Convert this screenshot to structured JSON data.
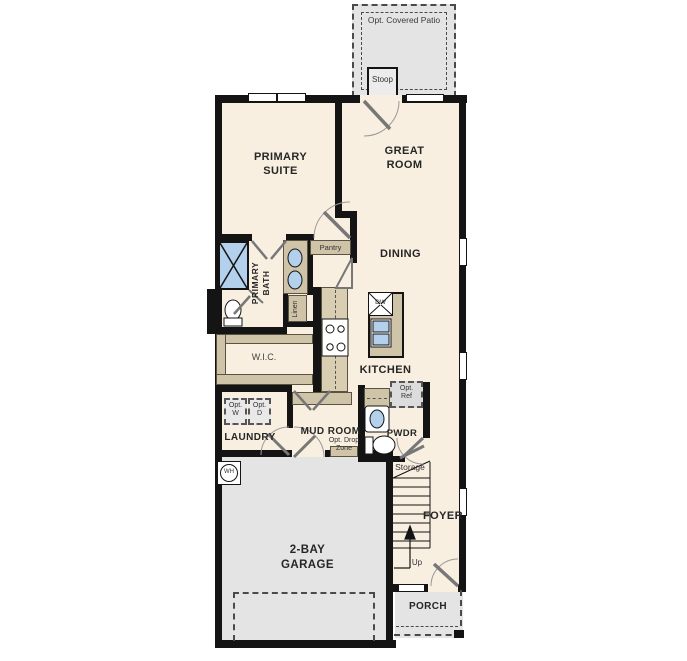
{
  "floor_plan": {
    "colors": {
      "wall": "#141414",
      "floor": "#f8efe1",
      "garage_floor": "#e4e4e4",
      "patio": "#e4e4e4",
      "cabinet": "#cfc3a8",
      "counter": "#d9cdb2",
      "fixture_blue": "#b3d0ec"
    },
    "labels": {
      "patio": "Opt. Covered Patio",
      "stoop": "Stoop",
      "primary_suite_1": "PRIMARY",
      "primary_suite_2": "SUITE",
      "great_room_1": "GREAT",
      "great_room_2": "ROOM",
      "dining": "DINING",
      "primary_bath_1": "PRIMARY",
      "primary_bath_2": "BATH",
      "pantry": "Pantry",
      "linen": "Linen",
      "wic": "W.I.C.",
      "kitchen": "KITCHEN",
      "dw": "DW",
      "opt_ref_1": "Opt.",
      "opt_ref_2": "Ref",
      "opt_w_1": "Opt.",
      "opt_w_2": "W",
      "opt_d_1": "Opt.",
      "opt_d_2": "D",
      "laundry": "LAUNDRY",
      "mud_room": "MUD ROOM",
      "opt_drop_1": "Opt. Drop",
      "opt_drop_2": "Zone",
      "pwdr": "PWDR",
      "storage": "Storage",
      "foyer": "FOYER",
      "up": "Up",
      "garage_1": "2-BAY",
      "garage_2": "GARAGE",
      "porch": "PORCH",
      "wh": "WH"
    }
  }
}
